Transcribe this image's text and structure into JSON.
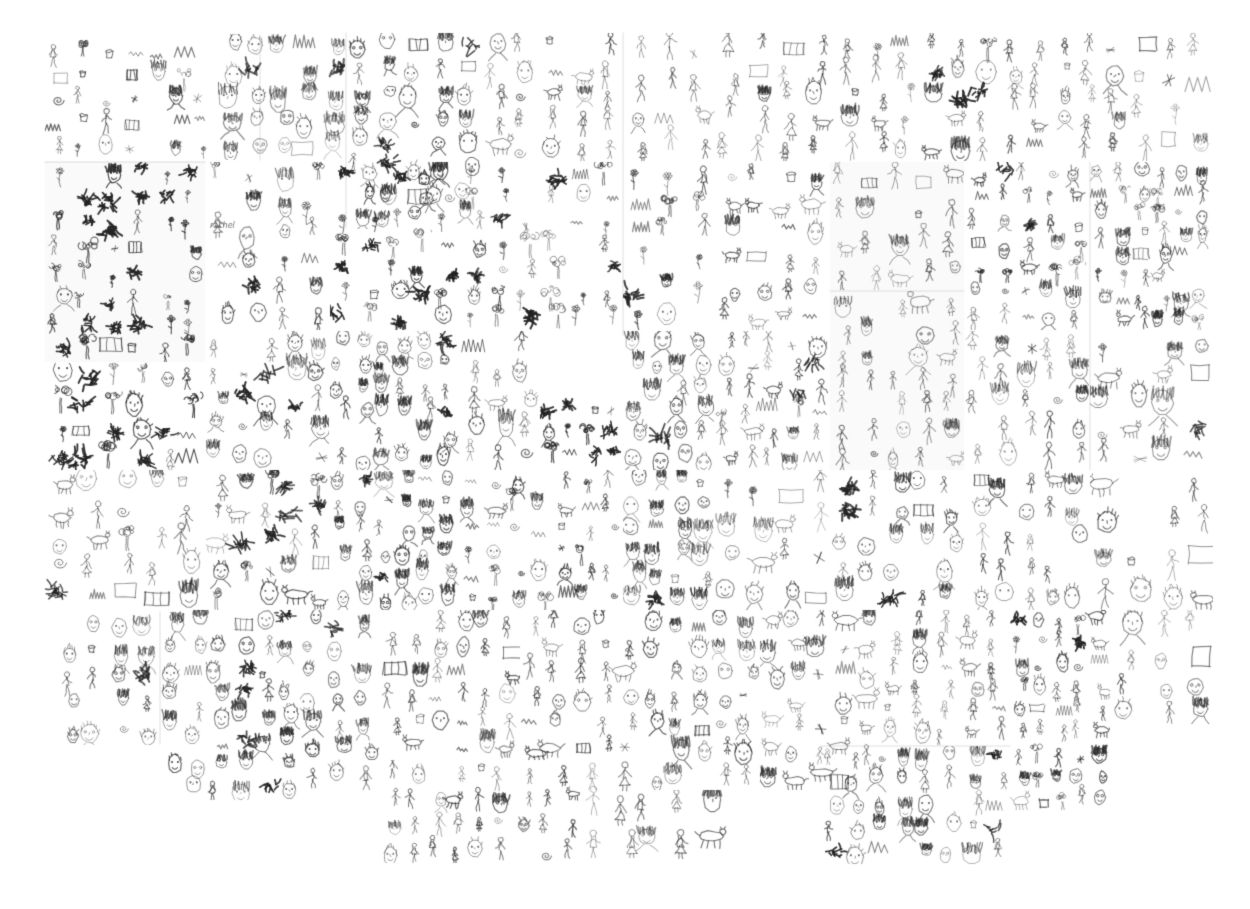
{
  "page": {
    "title": "Large collage of small hand-drawn pencil sketches (faces, people, animals, trees, objects) on white paper sheets",
    "background_color": "#ffffff",
    "ink_color": "#282828",
    "sheet_edge_color": "#6e6e6e",
    "canvas": {
      "width": 1250,
      "height": 909
    }
  },
  "collage": {
    "description": "Mosaic of scanned sketchbook sheets tiled edge to edge; each sheet is densely filled with tiny grayscale pencil doodles of varying darkness. Outer boundary is irregular, especially along the bottom.",
    "subjects_observed": [
      "faces",
      "portrait heads",
      "stick figures",
      "standing people",
      "animals",
      "trees",
      "plants",
      "flowers",
      "mountains",
      "scribble patches",
      "small objects"
    ],
    "seed": 1337,
    "handwritten_labels": [
      {
        "text": "rachel",
        "x": 210,
        "y": 228
      }
    ],
    "doodle_types": [
      "face",
      "figure",
      "animal",
      "plant",
      "blob",
      "object"
    ],
    "mix_presets": {
      "faces": {
        "face": 0.72,
        "figure": 0.14,
        "object": 0.08,
        "blob": 0.06
      },
      "figures": {
        "figure": 0.58,
        "face": 0.22,
        "animal": 0.08,
        "object": 0.12
      },
      "mixed": {
        "face": 0.3,
        "figure": 0.26,
        "animal": 0.1,
        "plant": 0.14,
        "object": 0.14,
        "blob": 0.06
      },
      "plants": {
        "plant": 0.42,
        "blob": 0.12,
        "figure": 0.16,
        "object": 0.14,
        "face": 0.16
      },
      "heavy": {
        "blob": 0.34,
        "plant": 0.24,
        "figure": 0.18,
        "object": 0.14,
        "face": 0.1
      },
      "animals": {
        "animal": 0.38,
        "figure": 0.22,
        "face": 0.22,
        "object": 0.18
      },
      "objects": {
        "object": 0.4,
        "figure": 0.18,
        "face": 0.18,
        "plant": 0.16,
        "animal": 0.08
      }
    },
    "tiles": [
      {
        "x": 45,
        "y": 40,
        "w": 170,
        "h": 120,
        "density": 1.15,
        "dark": 0.55,
        "mix": "objects"
      },
      {
        "x": 218,
        "y": 34,
        "w": 127,
        "h": 126,
        "density": 0.95,
        "dark": 0.4,
        "mix": "faces"
      },
      {
        "x": 346,
        "y": 33,
        "w": 134,
        "h": 196,
        "density": 1.0,
        "dark": 0.62,
        "mix": "faces"
      },
      {
        "x": 481,
        "y": 33,
        "w": 140,
        "h": 128,
        "density": 1.0,
        "dark": 0.45,
        "mix": "figures"
      },
      {
        "x": 623,
        "y": 33,
        "w": 121,
        "h": 128,
        "density": 0.8,
        "dark": 0.45,
        "mix": "figures"
      },
      {
        "x": 745,
        "y": 33,
        "w": 119,
        "h": 128,
        "density": 0.9,
        "dark": 0.5,
        "mix": "figures"
      },
      {
        "x": 865,
        "y": 33,
        "w": 133,
        "h": 128,
        "density": 1.0,
        "dark": 0.45,
        "mix": "mixed"
      },
      {
        "x": 1000,
        "y": 33,
        "w": 128,
        "h": 128,
        "density": 1.0,
        "dark": 0.45,
        "mix": "figures"
      },
      {
        "x": 1129,
        "y": 33,
        "w": 84,
        "h": 128,
        "density": 0.75,
        "dark": 0.4,
        "mix": "objects"
      },
      {
        "x": 45,
        "y": 162,
        "w": 160,
        "h": 200,
        "density": 1.1,
        "dark": 0.8,
        "mix": "heavy",
        "tint": true
      },
      {
        "x": 206,
        "y": 162,
        "w": 123,
        "h": 168,
        "density": 0.9,
        "dark": 0.5,
        "mix": "mixed"
      },
      {
        "x": 330,
        "y": 162,
        "w": 129,
        "h": 168,
        "density": 1.2,
        "dark": 0.72,
        "mix": "heavy"
      },
      {
        "x": 460,
        "y": 162,
        "w": 161,
        "h": 168,
        "density": 1.1,
        "dark": 0.5,
        "mix": "plants"
      },
      {
        "x": 623,
        "y": 162,
        "w": 91,
        "h": 168,
        "density": 0.9,
        "dark": 0.55,
        "mix": "plants"
      },
      {
        "x": 715,
        "y": 162,
        "w": 114,
        "h": 168,
        "density": 1.0,
        "dark": 0.5,
        "mix": "animals"
      },
      {
        "x": 830,
        "y": 162,
        "w": 134,
        "h": 128,
        "density": 0.85,
        "dark": 0.35,
        "mix": "figures",
        "tint": true
      },
      {
        "x": 965,
        "y": 162,
        "w": 124,
        "h": 168,
        "density": 1.3,
        "dark": 0.5,
        "mix": "mixed"
      },
      {
        "x": 1090,
        "y": 162,
        "w": 123,
        "h": 168,
        "density": 1.4,
        "dark": 0.5,
        "mix": "mixed"
      },
      {
        "x": 45,
        "y": 363,
        "w": 160,
        "h": 107,
        "density": 0.85,
        "dark": 0.78,
        "mix": "heavy"
      },
      {
        "x": 206,
        "y": 331,
        "w": 123,
        "h": 139,
        "density": 1.0,
        "dark": 0.5,
        "mix": "faces"
      },
      {
        "x": 330,
        "y": 331,
        "w": 129,
        "h": 139,
        "density": 1.45,
        "dark": 0.6,
        "mix": "faces"
      },
      {
        "x": 460,
        "y": 331,
        "w": 79,
        "h": 139,
        "density": 0.9,
        "dark": 0.5,
        "mix": "figures"
      },
      {
        "x": 540,
        "y": 396,
        "w": 81,
        "h": 74,
        "density": 1.5,
        "dark": 0.72,
        "mix": "heavy"
      },
      {
        "x": 623,
        "y": 331,
        "w": 91,
        "h": 139,
        "density": 1.2,
        "dark": 0.55,
        "mix": "faces"
      },
      {
        "x": 715,
        "y": 331,
        "w": 114,
        "h": 139,
        "density": 1.1,
        "dark": 0.5,
        "mix": "mixed"
      },
      {
        "x": 830,
        "y": 291,
        "w": 134,
        "h": 179,
        "density": 0.9,
        "dark": 0.32,
        "mix": "figures",
        "tint": true
      },
      {
        "x": 965,
        "y": 331,
        "w": 124,
        "h": 139,
        "density": 1.0,
        "dark": 0.45,
        "mix": "figures"
      },
      {
        "x": 1090,
        "y": 331,
        "w": 123,
        "h": 139,
        "density": 0.7,
        "dark": 0.4,
        "mix": "mixed"
      },
      {
        "x": 45,
        "y": 470,
        "w": 160,
        "h": 140,
        "density": 0.8,
        "dark": 0.5,
        "mix": "mixed"
      },
      {
        "x": 206,
        "y": 470,
        "w": 123,
        "h": 140,
        "density": 0.95,
        "dark": 0.5,
        "mix": "mixed"
      },
      {
        "x": 330,
        "y": 470,
        "w": 129,
        "h": 140,
        "density": 1.35,
        "dark": 0.55,
        "mix": "faces"
      },
      {
        "x": 460,
        "y": 470,
        "w": 161,
        "h": 140,
        "density": 1.4,
        "dark": 0.55,
        "mix": "objects"
      },
      {
        "x": 623,
        "y": 470,
        "w": 91,
        "h": 140,
        "density": 1.1,
        "dark": 0.5,
        "mix": "faces"
      },
      {
        "x": 715,
        "y": 470,
        "w": 114,
        "h": 140,
        "density": 0.7,
        "dark": 0.4,
        "mix": "mixed"
      },
      {
        "x": 830,
        "y": 470,
        "w": 134,
        "h": 140,
        "density": 1.0,
        "dark": 0.55,
        "mix": "faces"
      },
      {
        "x": 965,
        "y": 470,
        "w": 124,
        "h": 140,
        "density": 1.0,
        "dark": 0.5,
        "mix": "figures"
      },
      {
        "x": 1090,
        "y": 470,
        "w": 123,
        "h": 140,
        "density": 0.65,
        "dark": 0.35,
        "mix": "figures"
      },
      {
        "x": 56,
        "y": 610,
        "w": 104,
        "h": 135,
        "density": 1.0,
        "dark": 0.5,
        "mix": "faces"
      },
      {
        "x": 160,
        "y": 610,
        "w": 140,
        "h": 190,
        "density": 1.2,
        "dark": 0.55,
        "mix": "faces"
      },
      {
        "x": 300,
        "y": 610,
        "w": 80,
        "h": 180,
        "density": 1.1,
        "dark": 0.5,
        "mix": "faces"
      },
      {
        "x": 380,
        "y": 610,
        "w": 140,
        "h": 150,
        "density": 1.1,
        "dark": 0.5,
        "mix": "figures"
      },
      {
        "x": 520,
        "y": 610,
        "w": 120,
        "h": 150,
        "density": 1.05,
        "dark": 0.5,
        "mix": "figures"
      },
      {
        "x": 640,
        "y": 610,
        "w": 120,
        "h": 180,
        "density": 1.1,
        "dark": 0.5,
        "mix": "faces"
      },
      {
        "x": 760,
        "y": 610,
        "w": 120,
        "h": 180,
        "density": 1.0,
        "dark": 0.5,
        "mix": "animals"
      },
      {
        "x": 880,
        "y": 610,
        "w": 130,
        "h": 135,
        "density": 1.15,
        "dark": 0.5,
        "mix": "figures"
      },
      {
        "x": 1010,
        "y": 610,
        "w": 100,
        "h": 200,
        "density": 1.5,
        "dark": 0.6,
        "mix": "mixed"
      },
      {
        "x": 1110,
        "y": 610,
        "w": 103,
        "h": 120,
        "density": 0.7,
        "dark": 0.45,
        "mix": "faces"
      },
      {
        "x": 380,
        "y": 760,
        "w": 200,
        "h": 103,
        "density": 1.3,
        "dark": 0.5,
        "mix": "figures"
      },
      {
        "x": 582,
        "y": 760,
        "w": 58,
        "h": 98,
        "density": 0.6,
        "dark": 0.4,
        "mix": "figures"
      },
      {
        "x": 820,
        "y": 746,
        "w": 190,
        "h": 118,
        "density": 1.2,
        "dark": 0.55,
        "mix": "faces"
      },
      {
        "x": 632,
        "y": 790,
        "w": 100,
        "h": 70,
        "density": 0.5,
        "dark": 0.4,
        "mix": "figures"
      }
    ],
    "sheet_edges": [
      [
        260,
        35,
        260,
        160
      ],
      [
        623,
        33,
        623,
        335
      ],
      [
        346,
        33,
        346,
        228
      ],
      [
        45,
        162,
        205,
        162
      ],
      [
        830,
        291,
        964,
        291
      ],
      [
        1090,
        162,
        1090,
        470
      ],
      [
        160,
        612,
        160,
        744
      ],
      [
        820,
        746,
        1010,
        746
      ]
    ]
  }
}
